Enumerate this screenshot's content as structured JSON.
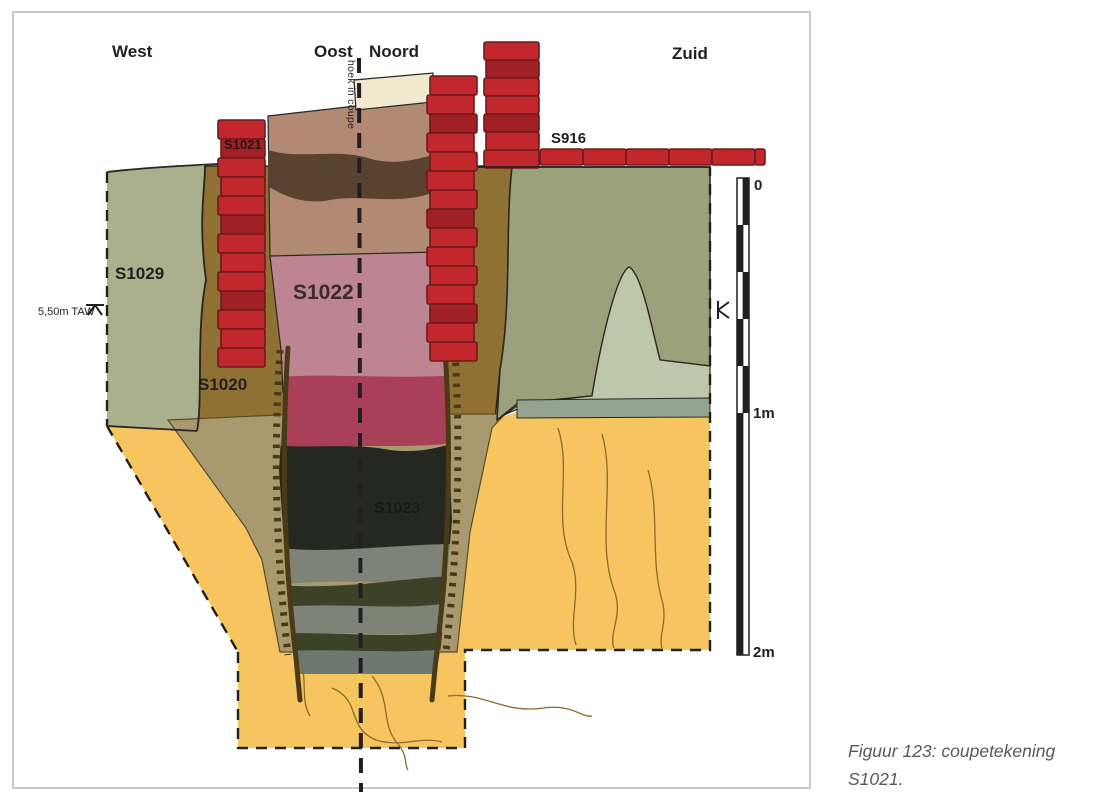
{
  "figure": {
    "caption": {
      "line1": "Figuur 123: coupetekening",
      "line2": "S1021."
    }
  },
  "directions": {
    "west": "West",
    "oost": "Oost",
    "noord": "Noord",
    "zuid": "Zuid"
  },
  "annotations": {
    "corner_note": "hoek in coupe",
    "taw_level": "5,50m TAW"
  },
  "features": {
    "s1021": "S1021",
    "s916": "S916",
    "s1029": "S1029",
    "s1020": "S1020",
    "s1022": "S1022",
    "s1023": "S1023"
  },
  "scale_bar": {
    "zero": "0",
    "one": "1m",
    "two": "2m"
  },
  "colors": {
    "ink": "#231f20",
    "border": "#b9b9b9",
    "captioncol": "#58595b",
    "yellow": "#f6c55f",
    "khaki": "#a89a6e",
    "brown": "#8f7233",
    "greenleft": "#a9b08b",
    "greenright": "#9aa17b",
    "sagelight": "#bfc7ab",
    "graygreen": "#93a390",
    "cream": "#f1e8d0",
    "pinkbrown": "#b28a74",
    "darkband": "#5a4230",
    "pink": "#bd8591",
    "crimson": "#a93f58",
    "shaftblack": "#242820",
    "grayband": "#7d8477",
    "oliveband": "#3c4127",
    "bluegray": "#6d7873",
    "brick": "#c1272d",
    "brickdark": "#a02025",
    "brickline": "#6e1a1d",
    "stake": "#4a3a16",
    "squiggle": "#8a6a30"
  }
}
